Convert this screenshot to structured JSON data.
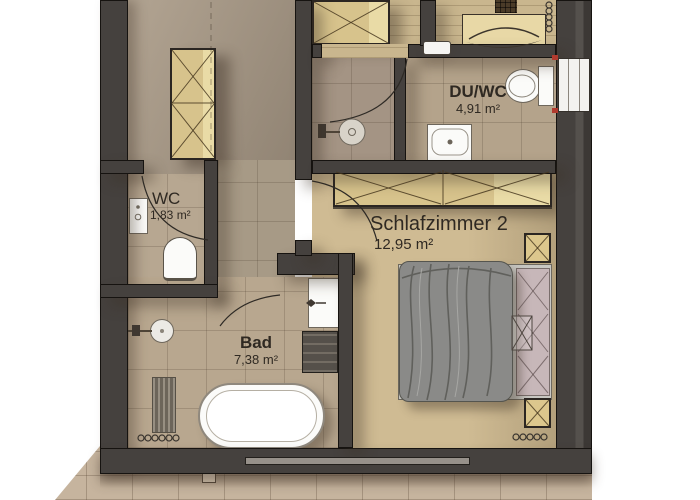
{
  "rooms": [
    {
      "id": "du-wc",
      "name": "DU/WC",
      "area": "4,91 m²"
    },
    {
      "id": "schlafzimmer-2",
      "name": "Schlafzimmer 2",
      "area": "12,95 m²"
    },
    {
      "id": "wc",
      "name": "WC",
      "area": "1,83 m²"
    },
    {
      "id": "bad",
      "name": "Bad",
      "area": "7,38 m²"
    }
  ],
  "fixtures": [
    "bathtub",
    "round-washbasin",
    "towel-radiator",
    "radiator-coil",
    "toilet",
    "hand-washbasin",
    "wall-washbasin",
    "dark-radiator",
    "shower-drain",
    "double-bed",
    "blanket",
    "headboard-panel",
    "nightstand",
    "wardrobe",
    "hall-closet",
    "vanity-counter",
    "window",
    "door-swing-arc",
    "terrace"
  ],
  "colors": {
    "wall": "#45413e",
    "floor_tile_hall": "#a89a87",
    "floor_tile_bath": "#b7a68f",
    "floor_tile_shower": "#a49484",
    "floor_wood_bedroom": "#cdb890",
    "terrace": "#c6b49e",
    "closet_wood": "#d7c38c",
    "bed_blanket": "#8a8a88",
    "bed_headboard": "#c7b7b9",
    "nightstand": "#dcc78d",
    "fixture_white": "#fbfbf9",
    "label_text": "#2f2922",
    "accent_red": "#b03a2e"
  }
}
